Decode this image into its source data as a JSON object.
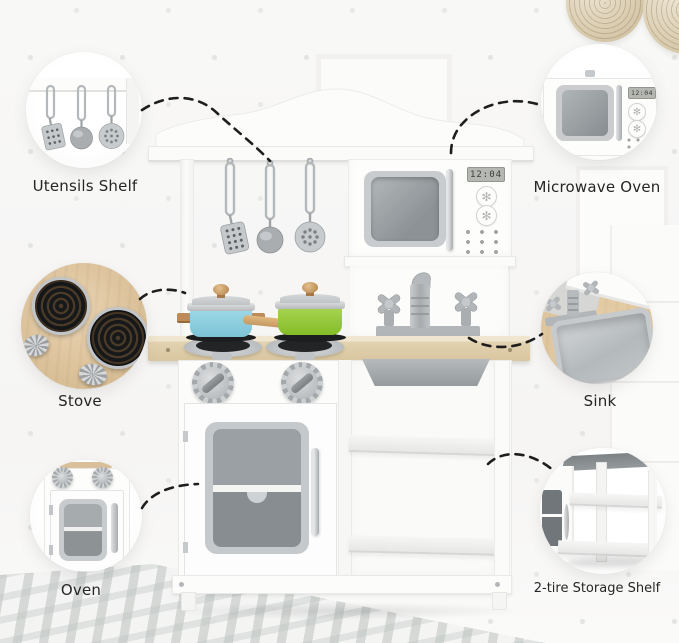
{
  "product": {
    "microwave_clock": "12:04"
  },
  "icons": {
    "flower_knob": "✻"
  },
  "callouts": [
    {
      "id": "utensils-shelf",
      "label": "Utensils Shelf"
    },
    {
      "id": "microwave-oven",
      "label": "Microwave Oven",
      "clock": "12:04"
    },
    {
      "id": "stove",
      "label": "Stove"
    },
    {
      "id": "sink",
      "label": "Sink"
    },
    {
      "id": "oven",
      "label": "Oven"
    },
    {
      "id": "storage-shelf",
      "label": "2-tire Storage Shelf"
    }
  ],
  "colors": {
    "background": "#f7f6f5",
    "arrow": "#1e1e1e",
    "pot_blue": "#8fd0e0",
    "pan_green": "#95c93d",
    "counter_wood": "#e2d2b4",
    "stove_wood": "#dcc29c",
    "silver": "#c3c6c8"
  }
}
